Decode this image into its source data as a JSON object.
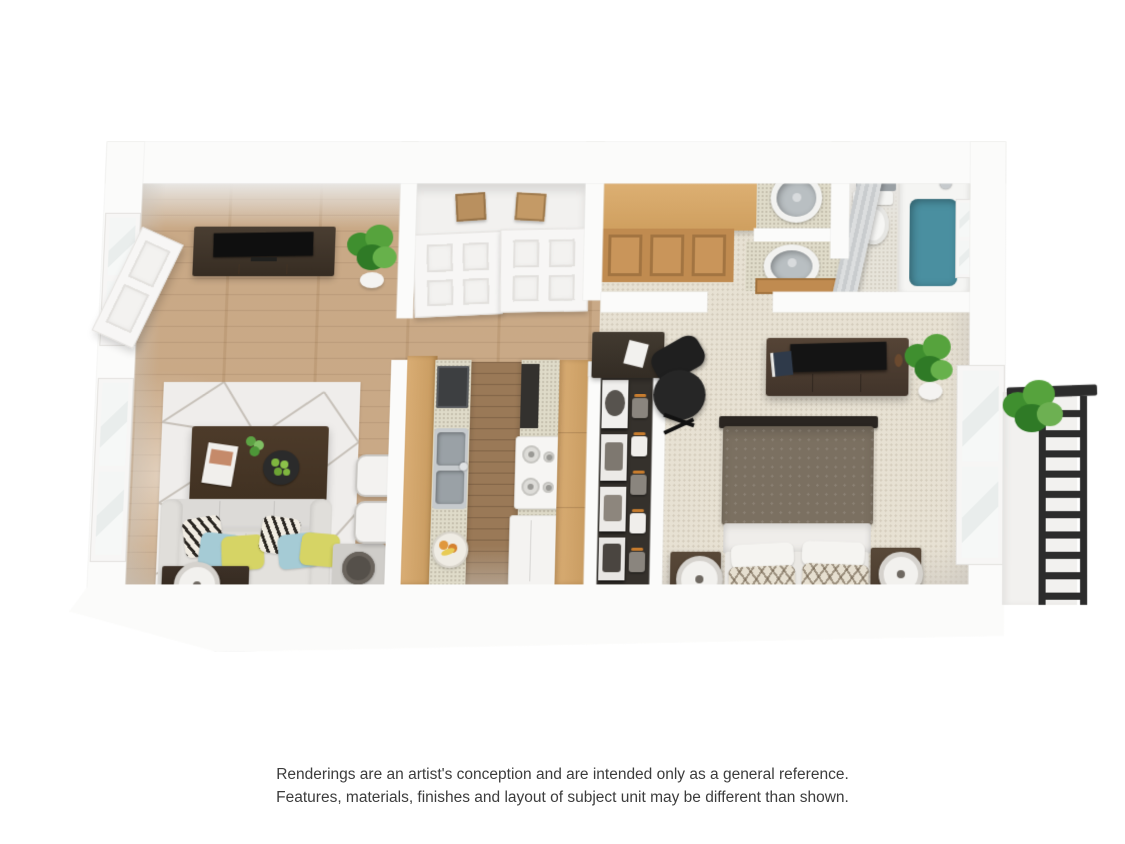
{
  "disclaimer": {
    "line1": "Renderings are an artist's conception and are intended only as a general reference.",
    "line2": "Features, materials, finishes and layout of subject unit may be different than shown."
  },
  "colors": {
    "bg": "#ffffff",
    "text": "#3c3c3c",
    "wall": "#fbfbfa",
    "wall-shade": "#e8e6e3",
    "wood-floor": "#c6a47f",
    "wood-floor-dark": "#9a7957",
    "carpet": "#e7e1d3",
    "bath-floor": "#e6e3d9",
    "rug": "#efedeb",
    "rug-line": "#c6c0b8",
    "cabinet-light": "#d9ad74",
    "cabinet-mid": "#c08b50",
    "counter": "#dfdbc9",
    "dark-wood": "#433528",
    "sofa": "#dcdad7",
    "pillow-yellow": "#d6d465",
    "pillow-blue": "#a5cbd5",
    "bed-duvet": "#7b7061",
    "tub-teal": "#4a8fa0",
    "steel": "#b0b6ba",
    "plant-green": "#4d9638",
    "railing-black": "#2c2c2c",
    "box-tan": "#b9905f",
    "chair-black": "#1f1f1f"
  }
}
